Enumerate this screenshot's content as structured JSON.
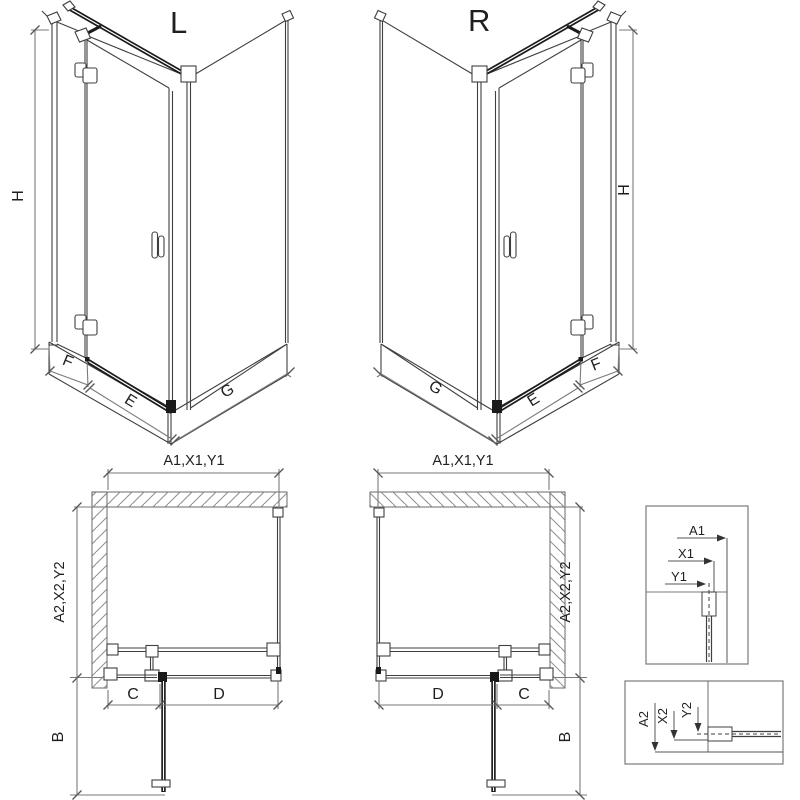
{
  "views": {
    "iso_left": {
      "label": "L",
      "dim_height": "H",
      "dim_fixed": "F",
      "dim_door": "E",
      "dim_side": "G"
    },
    "iso_right": {
      "label": "R",
      "dim_height": "H",
      "dim_fixed": "F",
      "dim_door": "E",
      "dim_side": "G"
    },
    "plan_left": {
      "dim_top": "A1,X1,Y1",
      "dim_side": "A2,X2,Y2",
      "dim_fixed": "C",
      "dim_door": "D",
      "dim_open": "B"
    },
    "plan_right": {
      "dim_top": "A1,X1,Y1",
      "dim_side": "A2,X2,Y2",
      "dim_fixed": "C",
      "dim_door": "D",
      "dim_open": "B"
    },
    "detail_width": {
      "dim_a": "A1",
      "dim_x": "X1",
      "dim_y": "Y1"
    },
    "detail_depth": {
      "dim_a": "A2",
      "dim_x": "X2",
      "dim_y": "Y2"
    }
  },
  "colors": {
    "line": "#3f3f3f",
    "dim_line": "#7a7a7a",
    "heavy": "#1a1a1a",
    "hatch": "#8f8f8f",
    "text": "#1f1f1f",
    "background": "#ffffff"
  }
}
